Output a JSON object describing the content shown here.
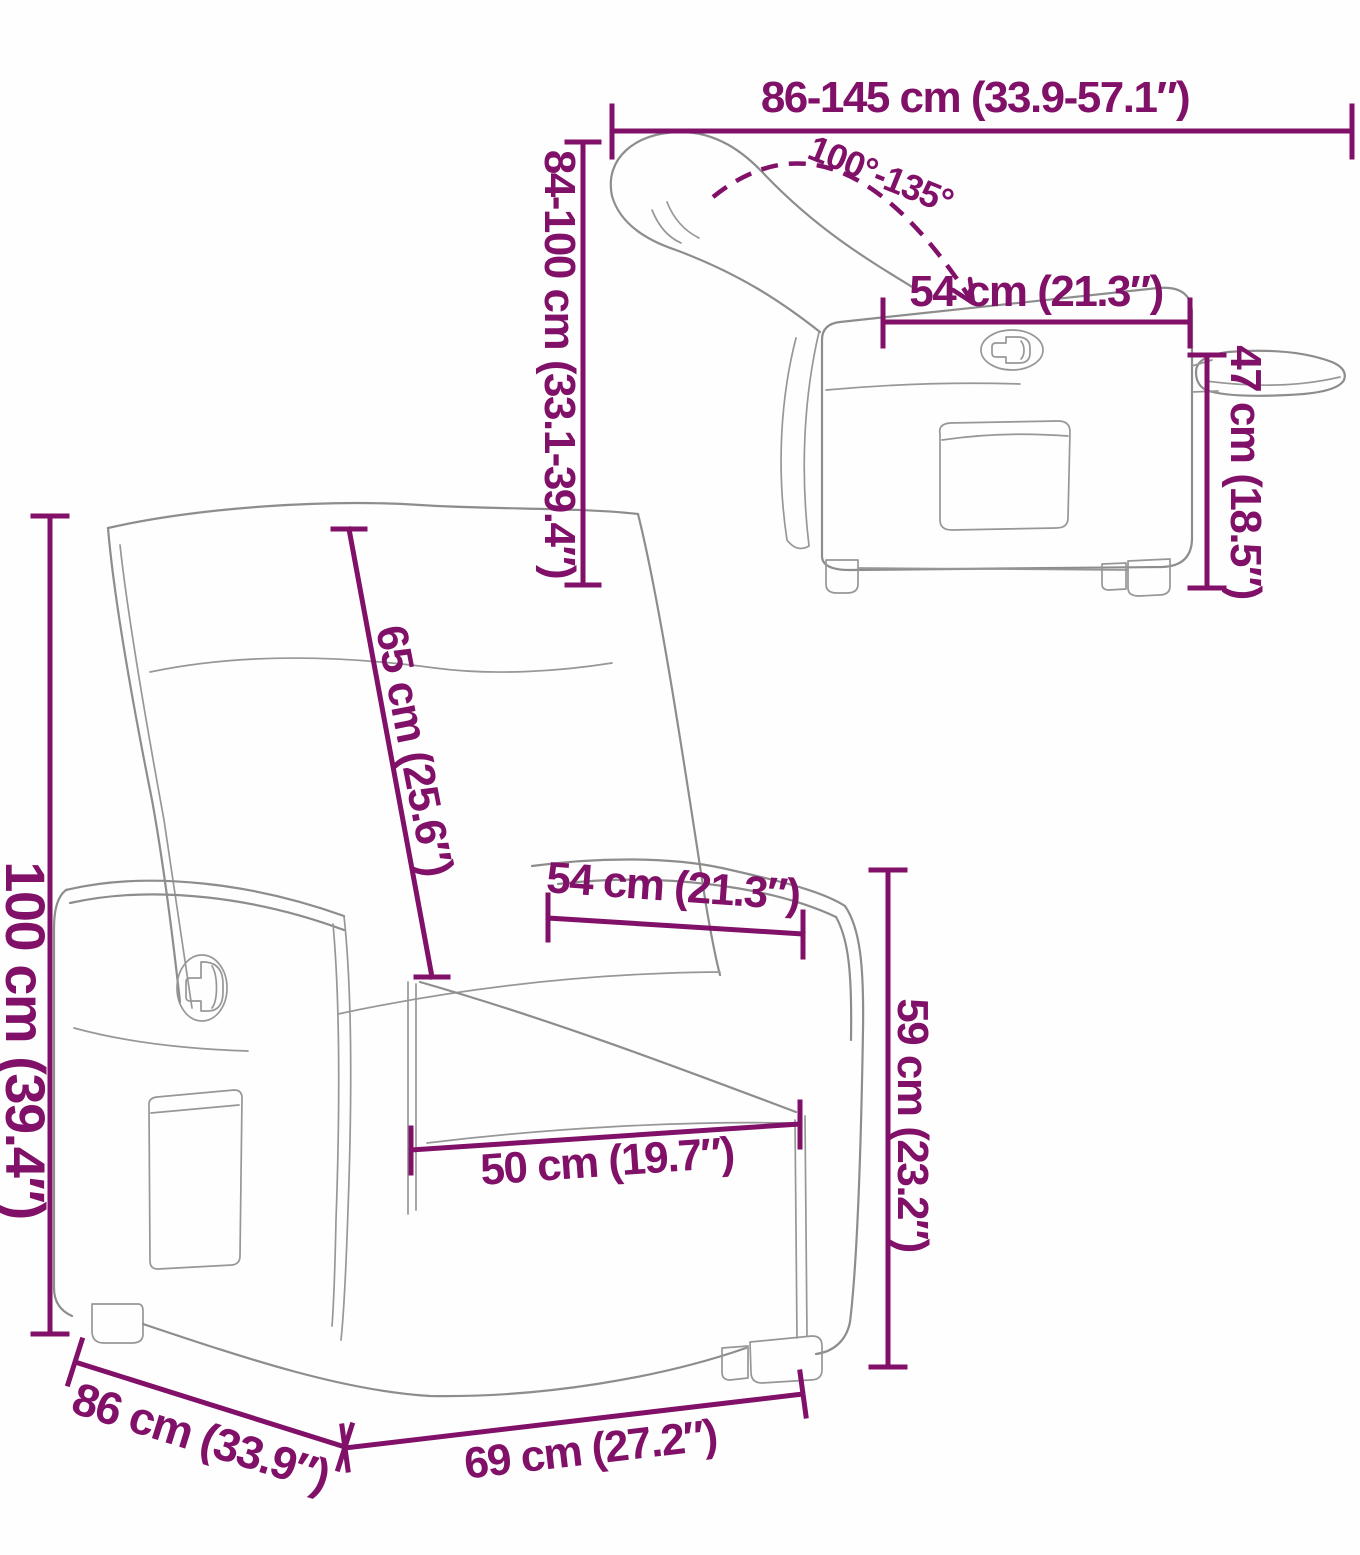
{
  "diagram": {
    "background": "#ffffff",
    "accent_color": "#801068",
    "line_art_color": "#8d8d8d",
    "side_view": {
      "extended_length": "86-145 cm (33.9-57.1″)",
      "recline_angle": "100°-135°",
      "backrest_height": "84-100 cm (33.1-39.4″)",
      "seat_depth": "54 cm (21.3″)",
      "seat_height": "47 cm (18.5″)"
    },
    "front_view": {
      "total_height": "100 cm (39.4″)",
      "backrest_length": "65 cm (25.6″)",
      "seat_width_rear": "54 cm (21.3″)",
      "armrest_height": "59 cm (23.2″)",
      "seat_width_front": "50 cm (19.7″)",
      "total_depth": "86 cm (33.9″)",
      "total_width": "69 cm (27.2″)"
    }
  }
}
